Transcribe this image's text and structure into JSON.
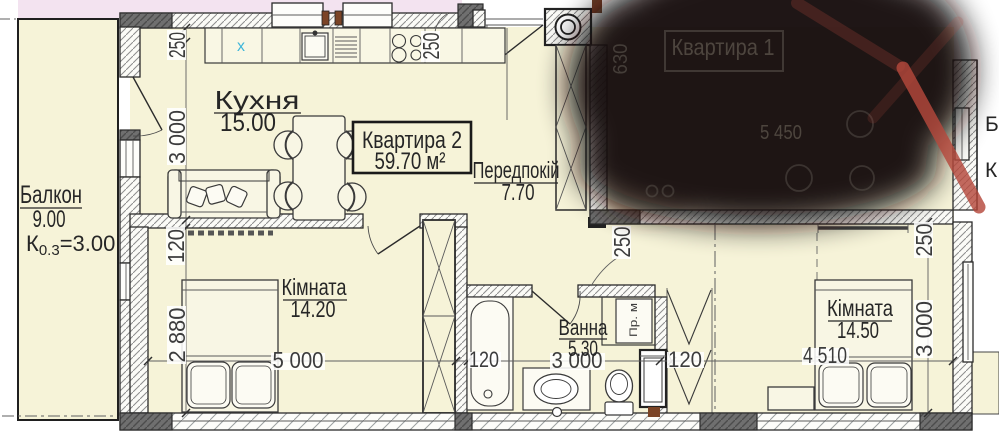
{
  "colors": {
    "floor": "#f6f3d8",
    "exterior": "#f3e3f0",
    "wall_dark": "#6f6f6f",
    "blob": "#121008",
    "red_mark": "#b5483c",
    "cyan_mark": "#3fb6d9",
    "dim_text": "#3c3c3c"
  },
  "apartment2": {
    "title": "Квартира 2",
    "area": "59.70 м²"
  },
  "apartment1": {
    "title": "Квартира 1",
    "dim_5450": "5 450",
    "dim_630": "630"
  },
  "rooms": {
    "balcony": {
      "name": "Балкон",
      "area": "9.00",
      "coef_prefix": "К",
      "coef_sub": "0.3",
      "coef_rest": "=3.00"
    },
    "kitchen": {
      "name": "Кухня",
      "area": "15.00"
    },
    "hallway": {
      "name": "Передпокій",
      "area": "7.70"
    },
    "bedroom1": {
      "name": "Кімната",
      "area": "14.20"
    },
    "bathroom": {
      "name": "Ванна",
      "area": "5.30"
    },
    "bedroom2": {
      "name": "Кімната",
      "area": "14.50"
    }
  },
  "fixtures": {
    "washing_machine": "Пр. м",
    "cabinet_mark": "x"
  },
  "edge": {
    "right_balcony": "Б",
    "right_coef": "К"
  },
  "dims": {
    "left_250": "250",
    "left_3000": "3 000",
    "left_120": "120",
    "left_2880": "2 880",
    "top_250": "250",
    "hall_250": "250",
    "b1_5000": "5 000",
    "bath_120l": "120",
    "bath_3000": "3 000",
    "bath_120r": "120",
    "b2_250": "250",
    "b2_3000": "3 000",
    "b2_4510": "4 510"
  }
}
